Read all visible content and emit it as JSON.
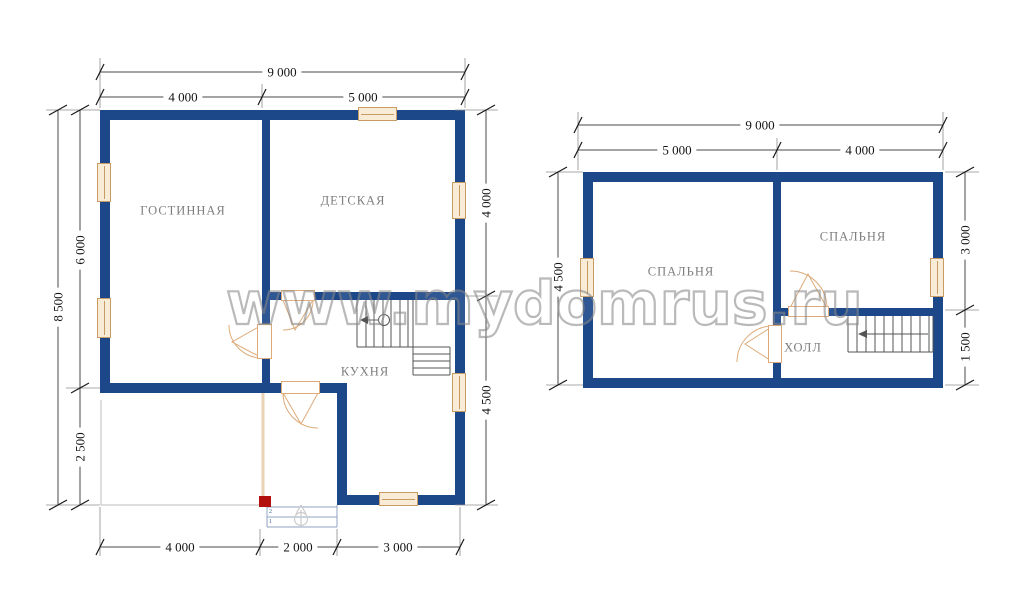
{
  "watermark": {
    "text": "www.mydomrus.ru"
  },
  "colors": {
    "wall": "#1c4789",
    "window_fill": "#f8ecd7",
    "window_border": "#c79b63",
    "door_line": "#ddab79",
    "red_marker": "#b30f0c"
  },
  "first_floor": {
    "rooms": {
      "living_room": "ГОСТИННАЯ",
      "kids_room": "ДЕТСКАЯ",
      "kitchen": "КУХНЯ"
    },
    "dims": {
      "top_total": "9 000",
      "top_left": "4 000",
      "top_right": "5 000",
      "left_total": "8 500",
      "left_upper": "6 000",
      "left_lower": "2 500",
      "right_upper": "4 000",
      "right_lower": "4 500",
      "bottom_left": "4 000",
      "bottom_mid": "2 000",
      "bottom_right": "3 000"
    },
    "steps": {
      "upper": "2",
      "lower": "1"
    }
  },
  "second_floor": {
    "rooms": {
      "bedroom_left": "СПАЛЬНЯ",
      "bedroom_right": "СПАЛЬНЯ",
      "hall": "ХОЛЛ"
    },
    "dims": {
      "top_total": "9 000",
      "top_left": "5 000",
      "top_right": "4 000",
      "left_total": "4 500",
      "right_upper": "3 000",
      "right_lower": "1 500"
    }
  }
}
